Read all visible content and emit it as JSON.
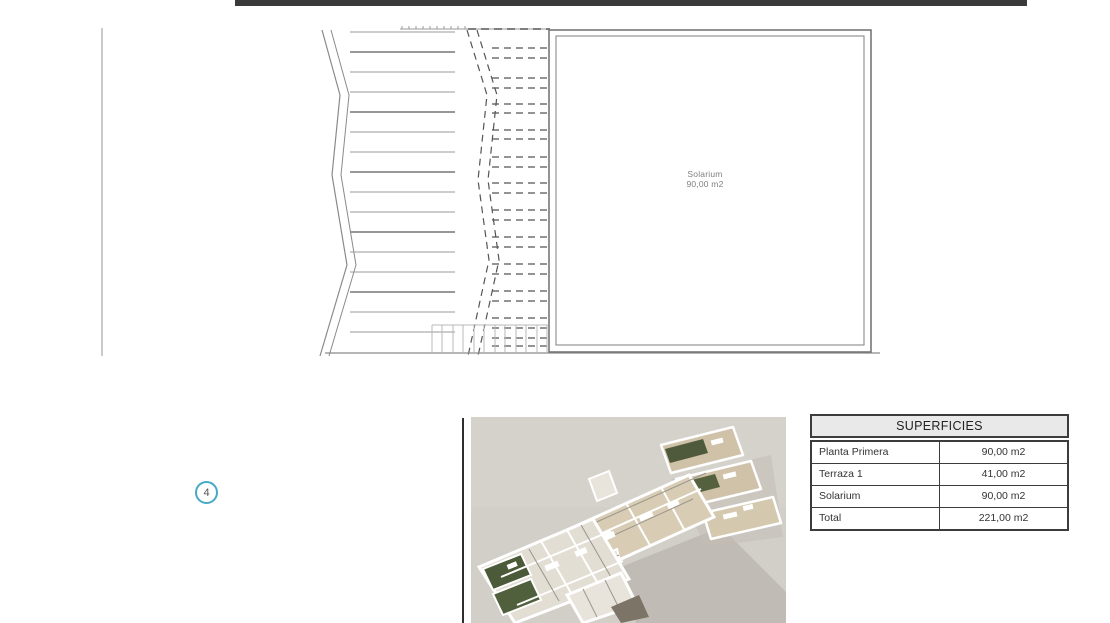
{
  "colors": {
    "top_bar": "#3a3a3a",
    "marker_ring": "#45a9c7",
    "table_header_bg": "#e9e9e9",
    "render_background": "#d2cfc9",
    "plan_line": "#8a8a8a"
  },
  "floor_plan": {
    "room_label": "Solarium",
    "room_area": "90,00 m2"
  },
  "marker": {
    "number": "4"
  },
  "table": {
    "title": "SUPERFICIES",
    "rows": [
      {
        "label": "Planta Primera",
        "value": "90,00 m2"
      },
      {
        "label": "Terraza 1",
        "value": "41,00 m2"
      },
      {
        "label": "Solarium",
        "value": "90,00 m2"
      },
      {
        "label": "Total",
        "value": "221,00 m2"
      }
    ]
  }
}
